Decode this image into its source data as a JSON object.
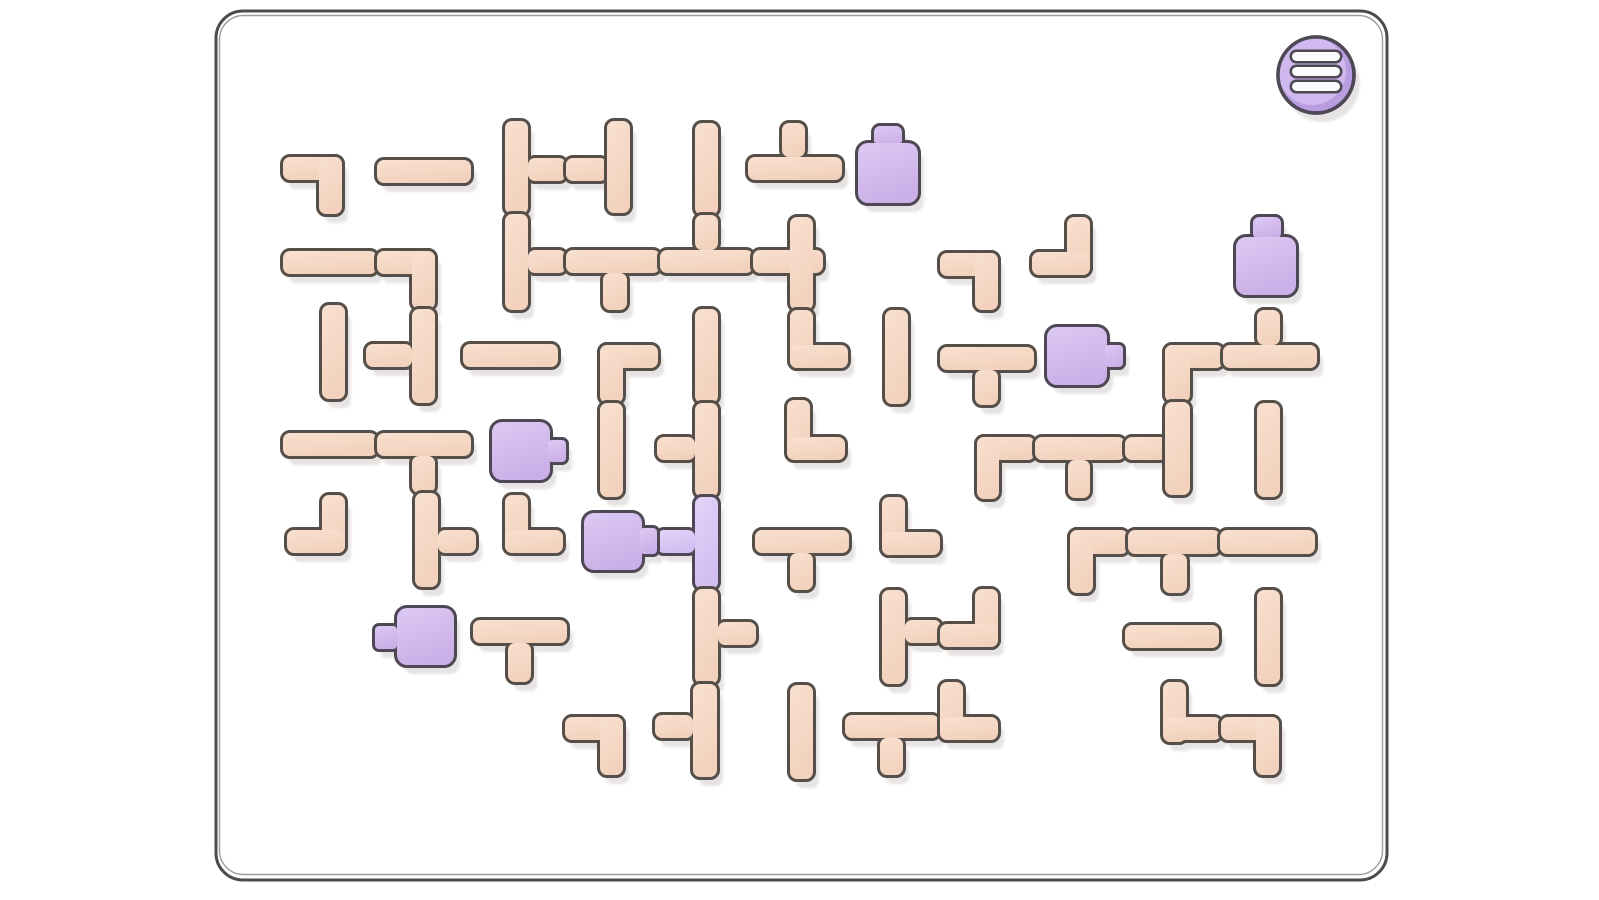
{
  "game": {
    "name": "pipe-rotation-puzzle",
    "board": {
      "x": 216,
      "y": 11,
      "width": 1171,
      "height": 869,
      "radius": 27
    },
    "menu_button": {
      "cx": 1316,
      "cy": 75,
      "radius": 38,
      "bar_count": 3,
      "bars": [
        {
          "x": 1292,
          "y": 52,
          "w": 48,
          "h": 9
        },
        {
          "x": 1292,
          "y": 67,
          "w": 48,
          "h": 9
        },
        {
          "x": 1292,
          "y": 82,
          "w": 48,
          "h": 9
        }
      ]
    },
    "colors": {
      "page_bg": "#ffffff",
      "board_stroke": "#4f4b48",
      "pipe_outline": "#564f49",
      "pipe_light": "#f9e0d0",
      "pipe_dark": "#f2d2bd",
      "source_outline": "#4e4754",
      "source_light": "#ddc9f4",
      "source_dark": "#cbb0e7",
      "liquid_light": "#e3d3f8",
      "liquid_dark": "#d3bef1",
      "menu_base": "#b89de0",
      "menu_face": "#cfb9ee",
      "menu_bar_fill": "#fbfafc",
      "shadow": "#e3e1e0"
    },
    "shadow_offset": {
      "dx": 6,
      "dy": 9
    },
    "pieces": [
      {
        "name": "pipe-elbow",
        "fill": "pipe",
        "rects": [
          [
            283,
            157,
            59,
            23
          ],
          [
            319,
            157,
            23,
            57
          ]
        ]
      },
      {
        "name": "pipe-straight",
        "fill": "pipe",
        "rects": [
          [
            377,
            160,
            94,
            23
          ]
        ]
      },
      {
        "name": "pipe-tee",
        "fill": "pipe",
        "rects": [
          [
            505,
            121,
            23,
            93
          ],
          [
            528,
            158,
            38,
            23
          ]
        ]
      },
      {
        "name": "pipe-straight",
        "fill": "pipe",
        "rects": [
          [
            566,
            158,
            41,
            23
          ]
        ]
      },
      {
        "name": "pipe-straight",
        "fill": "pipe",
        "rects": [
          [
            607,
            121,
            23,
            92
          ]
        ]
      },
      {
        "name": "pipe-straight",
        "fill": "pipe",
        "rects": [
          [
            695,
            123,
            23,
            92
          ]
        ]
      },
      {
        "name": "pipe-tee",
        "fill": "pipe",
        "rects": [
          [
            748,
            157,
            94,
            23
          ],
          [
            782,
            123,
            23,
            34
          ]
        ]
      },
      {
        "name": "pipe-straight",
        "fill": "pipe",
        "rects": [
          [
            283,
            251,
            94,
            23
          ]
        ]
      },
      {
        "name": "pipe-elbow",
        "fill": "pipe",
        "rects": [
          [
            377,
            251,
            58,
            23
          ],
          [
            412,
            251,
            23,
            58
          ]
        ]
      },
      {
        "name": "pipe-tee",
        "fill": "pipe",
        "rects": [
          [
            412,
            309,
            23,
            94
          ],
          [
            366,
            344,
            46,
            23
          ]
        ]
      },
      {
        "name": "pipe-straight",
        "fill": "pipe",
        "rects": [
          [
            322,
            305,
            23,
            94
          ]
        ]
      },
      {
        "name": "pipe-tee",
        "fill": "pipe",
        "rects": [
          [
            505,
            214,
            23,
            96
          ],
          [
            528,
            250,
            38,
            23
          ]
        ]
      },
      {
        "name": "pipe-tee",
        "fill": "pipe",
        "rects": [
          [
            566,
            250,
            94,
            23
          ],
          [
            603,
            273,
            24,
            37
          ]
        ]
      },
      {
        "name": "pipe-tee",
        "fill": "pipe",
        "rects": [
          [
            660,
            250,
            93,
            23
          ],
          [
            695,
            215,
            23,
            35
          ]
        ]
      },
      {
        "name": "pipe-cross",
        "fill": "pipe",
        "rects": [
          [
            753,
            250,
            70,
            23
          ],
          [
            790,
            217,
            23,
            93
          ]
        ]
      },
      {
        "name": "pipe-elbow",
        "fill": "pipe",
        "rects": [
          [
            790,
            310,
            23,
            58
          ],
          [
            790,
            345,
            58,
            23
          ]
        ]
      },
      {
        "name": "pipe-elbow",
        "fill": "pipe",
        "rects": [
          [
            787,
            400,
            23,
            58
          ],
          [
            787,
            437,
            58,
            23
          ]
        ]
      },
      {
        "name": "pipe-straight",
        "fill": "pipe",
        "rects": [
          [
            695,
            309,
            23,
            94
          ]
        ]
      },
      {
        "name": "pipe-tee",
        "fill": "pipe",
        "rects": [
          [
            695,
            403,
            23,
            94
          ],
          [
            657,
            437,
            38,
            23
          ]
        ]
      },
      {
        "name": "pipe-tee-filled",
        "fill": "liquid",
        "rects": [
          [
            695,
            497,
            23,
            92
          ],
          [
            657,
            530,
            38,
            23
          ]
        ]
      },
      {
        "name": "pipe-tee",
        "fill": "pipe",
        "rects": [
          [
            695,
            589,
            23,
            95
          ],
          [
            718,
            622,
            38,
            23
          ]
        ]
      },
      {
        "name": "pipe-tee",
        "fill": "pipe",
        "rects": [
          [
            693,
            684,
            24,
            93
          ],
          [
            655,
            715,
            38,
            23
          ]
        ]
      },
      {
        "name": "pipe-elbow",
        "fill": "pipe",
        "rects": [
          [
            600,
            345,
            58,
            23
          ],
          [
            600,
            345,
            23,
            58
          ]
        ]
      },
      {
        "name": "pipe-straight",
        "fill": "pipe",
        "rects": [
          [
            600,
            403,
            23,
            94
          ]
        ]
      },
      {
        "name": "pipe-straight",
        "fill": "pipe",
        "rects": [
          [
            463,
            344,
            95,
            23
          ]
        ]
      },
      {
        "name": "pipe-straight",
        "fill": "pipe",
        "rects": [
          [
            283,
            433,
            94,
            23
          ]
        ]
      },
      {
        "name": "pipe-tee",
        "fill": "pipe",
        "rects": [
          [
            377,
            433,
            94,
            23
          ],
          [
            412,
            456,
            23,
            37
          ]
        ]
      },
      {
        "name": "pipe-tee",
        "fill": "pipe",
        "rects": [
          [
            415,
            493,
            23,
            94
          ],
          [
            438,
            530,
            38,
            23
          ]
        ]
      },
      {
        "name": "pipe-elbow",
        "fill": "pipe",
        "rects": [
          [
            322,
            495,
            23,
            58
          ],
          [
            287,
            530,
            58,
            23
          ]
        ]
      },
      {
        "name": "pipe-elbow",
        "fill": "pipe",
        "rects": [
          [
            505,
            495,
            23,
            58
          ],
          [
            505,
            530,
            58,
            23
          ]
        ]
      },
      {
        "name": "pipe-tee",
        "fill": "pipe",
        "rects": [
          [
            473,
            620,
            94,
            23
          ],
          [
            508,
            643,
            23,
            39
          ]
        ]
      },
      {
        "name": "pipe-elbow",
        "fill": "pipe",
        "rects": [
          [
            565,
            717,
            58,
            23
          ],
          [
            600,
            717,
            23,
            58
          ]
        ]
      },
      {
        "name": "pipe-straight",
        "fill": "pipe",
        "rects": [
          [
            790,
            685,
            23,
            94
          ]
        ]
      },
      {
        "name": "pipe-tee",
        "fill": "pipe",
        "rects": [
          [
            755,
            530,
            94,
            23
          ],
          [
            790,
            553,
            23,
            37
          ]
        ]
      },
      {
        "name": "pipe-elbow",
        "fill": "pipe",
        "rects": [
          [
            940,
            253,
            58,
            23
          ],
          [
            975,
            253,
            23,
            57
          ]
        ]
      },
      {
        "name": "pipe-elbow",
        "fill": "pipe",
        "rects": [
          [
            1067,
            217,
            23,
            58
          ],
          [
            1032,
            252,
            58,
            23
          ]
        ]
      },
      {
        "name": "pipe-straight",
        "fill": "pipe",
        "rects": [
          [
            885,
            310,
            23,
            94
          ]
        ]
      },
      {
        "name": "pipe-tee",
        "fill": "pipe",
        "rects": [
          [
            940,
            347,
            94,
            23
          ],
          [
            975,
            370,
            23,
            35
          ]
        ]
      },
      {
        "name": "pipe-elbow",
        "fill": "pipe",
        "rects": [
          [
            882,
            497,
            23,
            58
          ],
          [
            882,
            532,
            58,
            23
          ]
        ]
      },
      {
        "name": "pipe-tee",
        "fill": "pipe",
        "rects": [
          [
            882,
            590,
            23,
            94
          ],
          [
            905,
            620,
            36,
            23
          ]
        ]
      },
      {
        "name": "pipe-elbow",
        "fill": "pipe",
        "rects": [
          [
            975,
            589,
            23,
            58
          ],
          [
            940,
            624,
            58,
            23
          ]
        ]
      },
      {
        "name": "pipe-elbow",
        "fill": "pipe",
        "rects": [
          [
            977,
            437,
            58,
            23
          ],
          [
            977,
            437,
            22,
            62
          ]
        ]
      },
      {
        "name": "pipe-tee",
        "fill": "pipe",
        "rects": [
          [
            1035,
            437,
            90,
            23
          ],
          [
            1068,
            460,
            22,
            38
          ]
        ]
      },
      {
        "name": "pipe-straight",
        "fill": "pipe",
        "rects": [
          [
            1125,
            437,
            42,
            23
          ]
        ]
      },
      {
        "name": "pipe-elbow",
        "fill": "pipe",
        "rects": [
          [
            1165,
            345,
            58,
            23
          ],
          [
            1165,
            345,
            25,
            57
          ]
        ]
      },
      {
        "name": "pipe-straight",
        "fill": "pipe",
        "rects": [
          [
            1165,
            402,
            25,
            93
          ]
        ]
      },
      {
        "name": "pipe-tee",
        "fill": "pipe",
        "rects": [
          [
            1223,
            345,
            94,
            23
          ],
          [
            1257,
            310,
            23,
            35
          ]
        ]
      },
      {
        "name": "pipe-straight",
        "fill": "pipe",
        "rects": [
          [
            1257,
            403,
            23,
            94
          ]
        ]
      },
      {
        "name": "pipe-elbow",
        "fill": "pipe",
        "rects": [
          [
            1070,
            530,
            58,
            24
          ],
          [
            1070,
            530,
            23,
            63
          ]
        ]
      },
      {
        "name": "pipe-tee",
        "fill": "pipe",
        "rects": [
          [
            1128,
            530,
            92,
            24
          ],
          [
            1163,
            554,
            24,
            39
          ]
        ]
      },
      {
        "name": "pipe-straight",
        "fill": "pipe",
        "rects": [
          [
            1220,
            530,
            95,
            24
          ]
        ]
      },
      {
        "name": "pipe-straight",
        "fill": "pipe",
        "rects": [
          [
            1125,
            625,
            94,
            23
          ]
        ]
      },
      {
        "name": "pipe-straight",
        "fill": "pipe",
        "rects": [
          [
            1257,
            590,
            23,
            94
          ]
        ]
      },
      {
        "name": "pipe-elbow",
        "fill": "pipe",
        "rects": [
          [
            1163,
            682,
            23,
            60
          ],
          [
            1163,
            717,
            58,
            23
          ]
        ]
      },
      {
        "name": "pipe-elbow",
        "fill": "pipe",
        "rects": [
          [
            1221,
            717,
            58,
            23
          ],
          [
            1256,
            717,
            23,
            58
          ]
        ]
      },
      {
        "name": "pipe-tee",
        "fill": "pipe",
        "rects": [
          [
            845,
            715,
            94,
            23
          ],
          [
            880,
            738,
            23,
            37
          ]
        ]
      },
      {
        "name": "pipe-elbow",
        "fill": "pipe",
        "rects": [
          [
            940,
            682,
            23,
            58
          ],
          [
            940,
            717,
            58,
            23
          ]
        ]
      }
    ],
    "sources": [
      {
        "name": "flask-source",
        "fill": "source",
        "rects": [
          [
            874,
            126,
            28,
            20,
            6
          ],
          [
            858,
            143,
            60,
            60,
            10
          ]
        ]
      },
      {
        "name": "flask-source",
        "fill": "source",
        "rects": [
          [
            1253,
            217,
            28,
            22,
            6
          ],
          [
            1236,
            237,
            60,
            58,
            10
          ]
        ]
      },
      {
        "name": "pump-source",
        "fill": "source",
        "rects": [
          [
            492,
            422,
            58,
            58,
            10
          ],
          [
            548,
            440,
            18,
            22,
            4
          ]
        ]
      },
      {
        "name": "pump-source",
        "fill": "source",
        "rects": [
          [
            584,
            513,
            58,
            57,
            10
          ],
          [
            640,
            528,
            17,
            26,
            4
          ]
        ]
      },
      {
        "name": "pump-source",
        "fill": "source",
        "rects": [
          [
            397,
            608,
            57,
            57,
            10
          ],
          [
            375,
            626,
            22,
            23,
            4
          ]
        ]
      },
      {
        "name": "pump-source",
        "fill": "source",
        "rects": [
          [
            1047,
            327,
            60,
            58,
            10
          ],
          [
            1105,
            345,
            18,
            22,
            4
          ]
        ]
      }
    ]
  }
}
